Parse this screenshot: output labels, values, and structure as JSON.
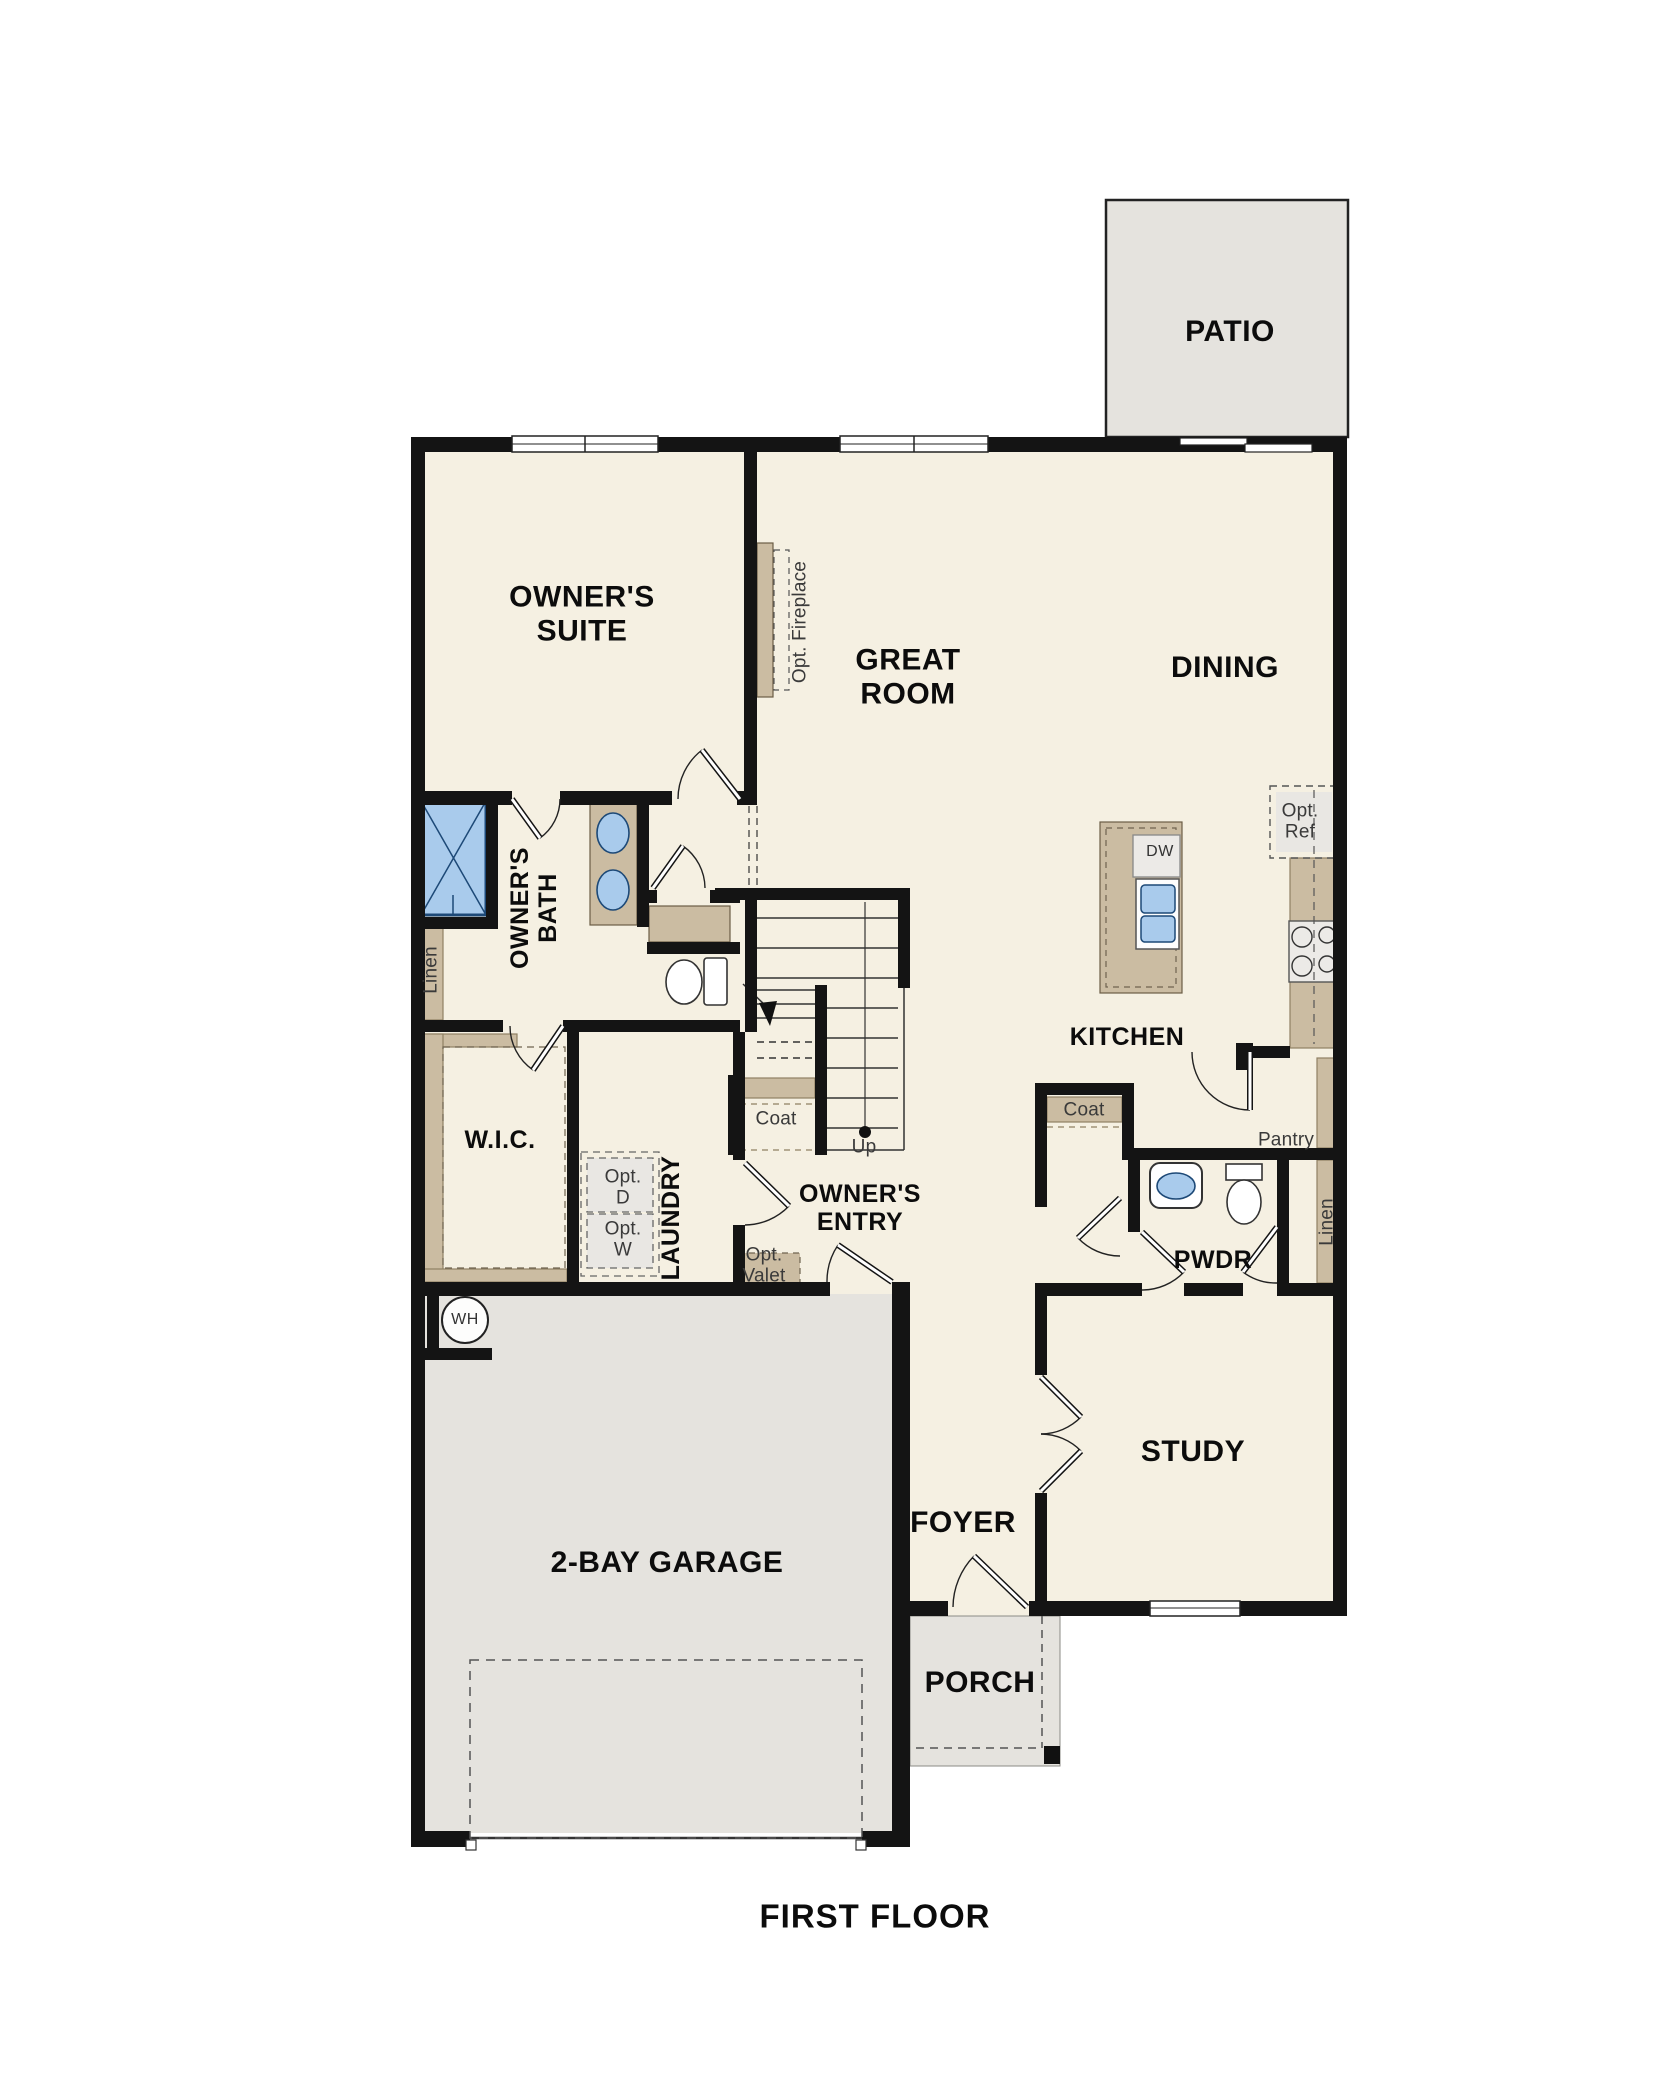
{
  "caption": "FIRST FLOOR",
  "colors": {
    "floor_cream": "#f5f0e2",
    "concrete_gray": "#e5e3de",
    "cabinet_tan": "#cbbca2",
    "fixture_blue": "#a9cbec",
    "wall_black": "#141414"
  },
  "labels": {
    "patio": "PATIO",
    "owners_suite": "OWNER'S\nSUITE",
    "great_room": "GREAT\nROOM",
    "dining": "DINING",
    "opt_fireplace": "Opt. Fireplace",
    "owners_bath": "OWNER'S\nBATH",
    "linen_bath": "Linen",
    "wic": "W.I.C.",
    "laundry": "LAUNDRY",
    "opt_dryer": "Opt.\nD",
    "opt_washer": "Opt.\nW",
    "opt_valet": "Opt.\nValet",
    "coat_stairs": "Coat",
    "up": "Up",
    "owners_entry": "OWNER'S\nENTRY",
    "kitchen": "KITCHEN",
    "dishwasher": "DW",
    "opt_ref": "Opt.\nRef",
    "coat_kitchen": "Coat",
    "pantry": "Pantry",
    "pwdr": "PWDR",
    "linen_hall": "Linen",
    "study": "STUDY",
    "foyer": "FOYER",
    "porch": "PORCH",
    "garage": "2-BAY GARAGE",
    "water_heater": "WH",
    "first_floor": "FIRST FLOOR"
  }
}
